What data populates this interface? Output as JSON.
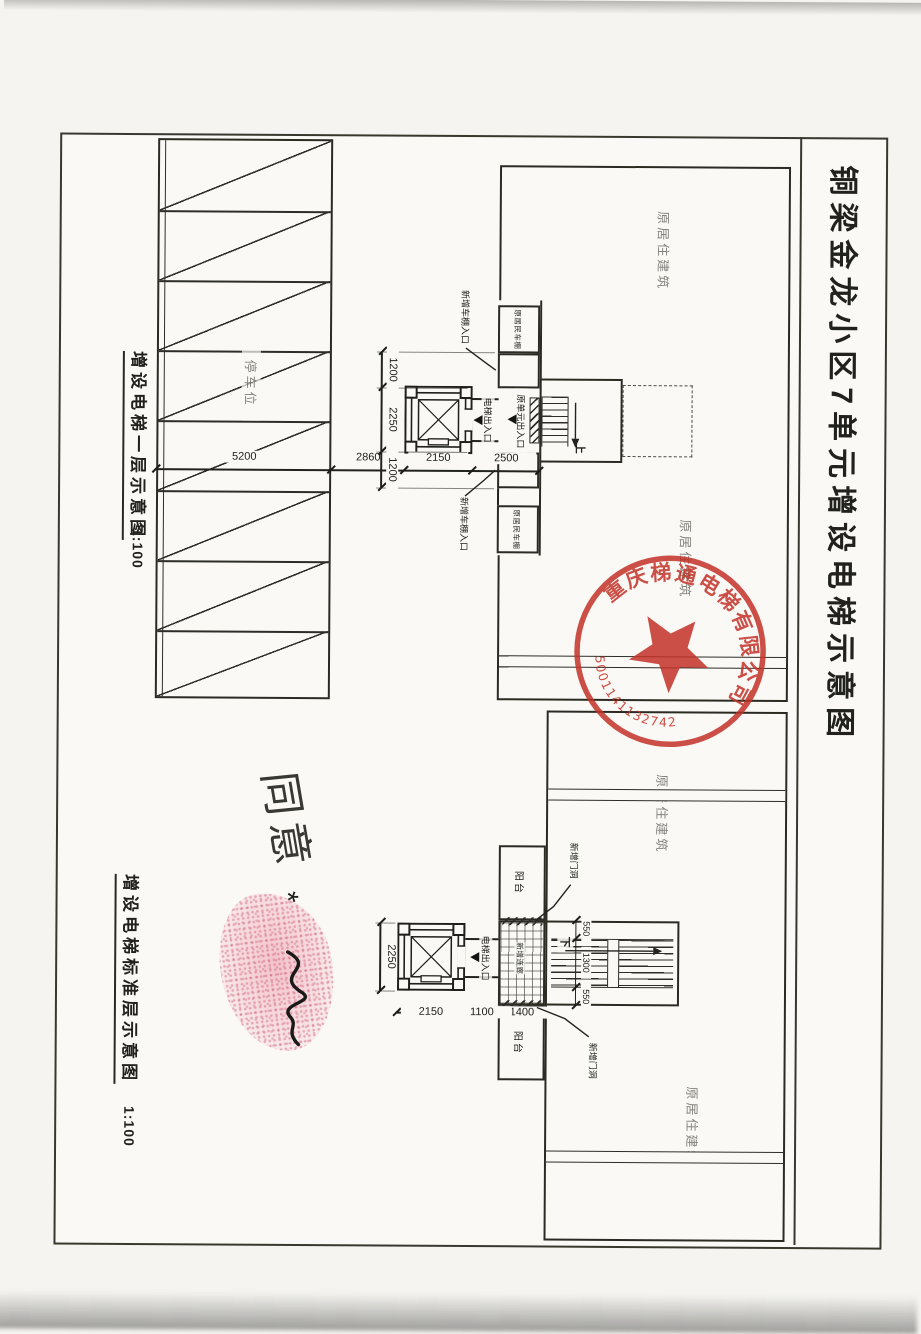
{
  "sheet": {
    "title": "铜梁金龙小区7单元增设电梯示意图"
  },
  "plan1": {
    "caption": "增设电梯一层示意图",
    "scale": "1:100",
    "building_label": "原居住建筑",
    "parking_label": "停车位",
    "shed_label": "原居民车棚",
    "shed_entrance_label": "新增车棚入口",
    "unit_entrance_label": "原单元出入口",
    "elevator_entrance_label": "电梯出入口",
    "stair_up": "上",
    "dims_v": [
      "2500",
      "2150",
      "2860",
      "5200"
    ],
    "dims_h": [
      "1200",
      "2250",
      "1200"
    ]
  },
  "plan2": {
    "caption": "增设电梯标准层示意图",
    "scale": "1:100",
    "building_label": "原居住建筑",
    "balcony_label": "阳台",
    "corridor_label": "新增连廊",
    "door_label": "新增门洞",
    "elevator_entrance_label": "电梯出入口",
    "stair_down": "下",
    "elevator_width": "2250",
    "dims_v": [
      "1400",
      "1100",
      "2150"
    ],
    "stair_dims": [
      "550",
      "1300",
      "550"
    ]
  },
  "stamp": {
    "company": "重庆梯通电梯有限公司",
    "number": "5001141132742",
    "color": "#c23227"
  },
  "marks": {
    "note": "同意",
    "asterisk": "*"
  }
}
